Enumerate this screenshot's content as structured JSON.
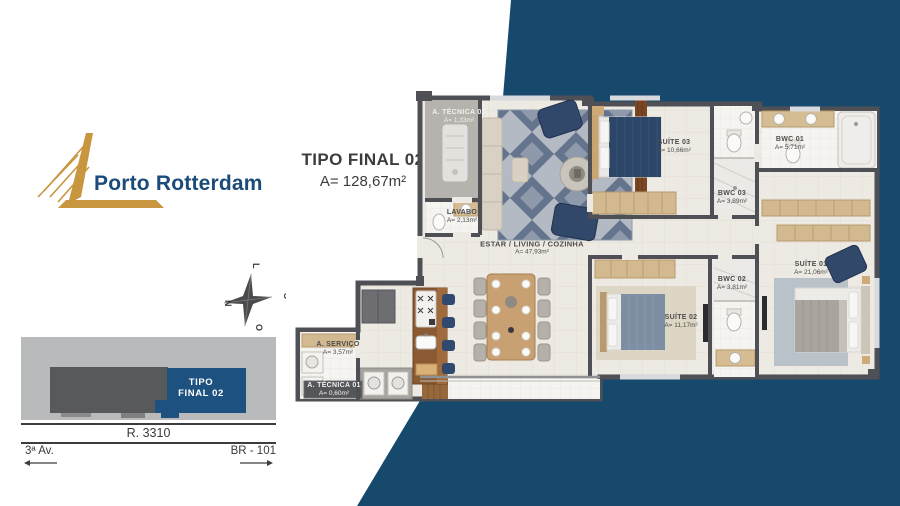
{
  "brand": {
    "logo_text": "Porto Rotterdam",
    "colors": {
      "navy_background": "#17496d",
      "logo_gold": "#c8963f",
      "logo_text_navy": "#1a4b79",
      "site_unit_navy": "#1d5180"
    }
  },
  "header": {
    "title": "TIPO FINAL 02",
    "area": "A= 128,67m²"
  },
  "compass": {
    "top": "L",
    "right": "S",
    "bottom": "O",
    "left": "N"
  },
  "site_map": {
    "unit_label_line1": "TIPO",
    "unit_label_line2": "FINAL 02",
    "street_front": "R. 3310",
    "street_left": "3ª Av.",
    "street_right": "BR - 101"
  },
  "plan": {
    "rooms": [
      {
        "name": "A. TÉCNICA 02",
        "area": "A= 1,33m²"
      },
      {
        "name": "LAVABO",
        "area": "A= 2,13m²"
      },
      {
        "name": "ESTAR / LIVING / COZINHA",
        "area": "A= 47,93m²"
      },
      {
        "name": "SUÍTE 03",
        "area": "A= 10,66m²"
      },
      {
        "name": "BWC 01",
        "area": "A= 5,71m²"
      },
      {
        "name": "BWC 03",
        "area": "A= 3,89m²"
      },
      {
        "name": "SUÍTE 01",
        "area": "A= 21,06m²"
      },
      {
        "name": "BWC 02",
        "area": "A= 3,81m²"
      },
      {
        "name": "SUÍTE 02",
        "area": "A= 11,17m²"
      },
      {
        "name": "A. SERVIÇO",
        "area": "A= 3,57m²"
      },
      {
        "name": "A. TÉCNICA 01",
        "area": "A= 0,60m²"
      }
    ]
  }
}
